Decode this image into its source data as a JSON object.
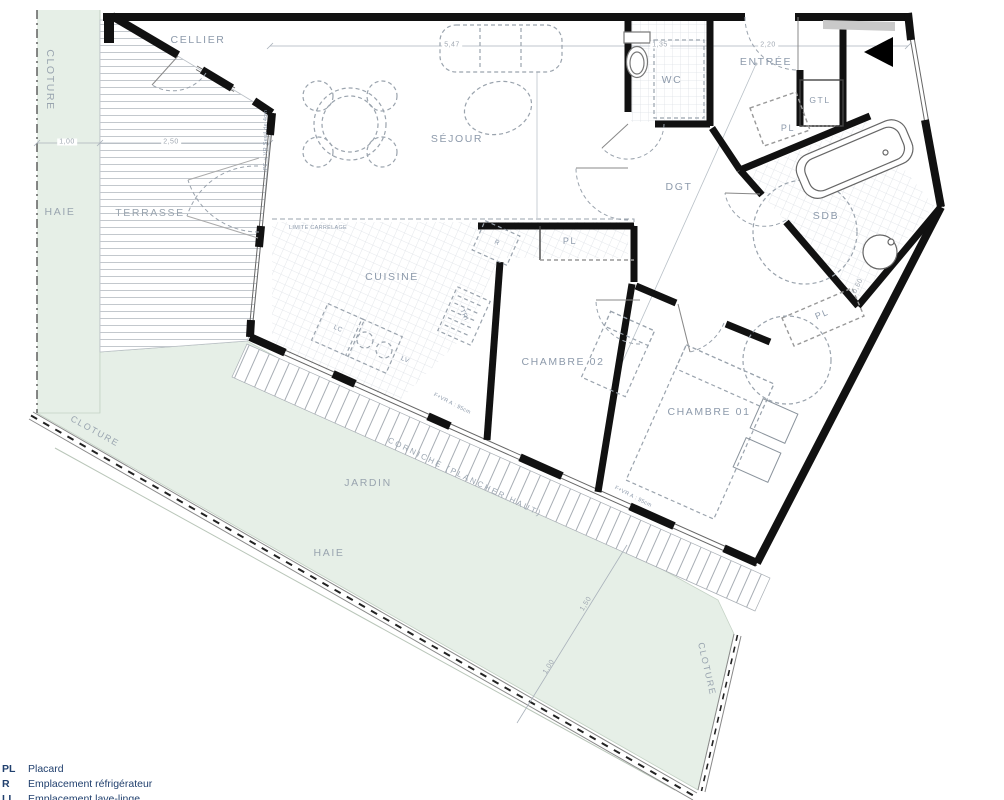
{
  "labels": {
    "cellier": "CELLIER",
    "sejour": "SÉJOUR",
    "wc": "WC",
    "entree": "ENTRÉE",
    "gtl": "GTL",
    "dgt": "DGT",
    "sdb": "SDB",
    "cuisine": "CUISINE",
    "chambre02": "CHAMBRE 02",
    "chambre01": "CHAMBRE 01",
    "pl": "PL",
    "terrasse": "TERRASSE",
    "jardin": "JARDIN",
    "haie": "HAIE",
    "cloture": "CLOTURE",
    "limite_carrelage": "LIMITE CARRELAGE",
    "corniche": "CORNICHE (PLANCHER HAUT)",
    "pf_vr_seuil": "PF + VR  Seuil de 4cm",
    "f_vr_allege": "F+VR  A : 95cm",
    "r": "R",
    "tri": "TRI",
    "lc": "LC",
    "lv": "LV"
  },
  "dimensions": {
    "haie_w": "1,00",
    "terrasse_w": "2,50",
    "sejour_w": "5,47",
    "wc_w": "1,35",
    "entree_w": "2,20",
    "jardin_a": "1,50",
    "jardin_b": "1,00",
    "sdb_a": "0,60"
  },
  "legend": {
    "rows": [
      {
        "code": "PL",
        "label": "Placard"
      },
      {
        "code": "R",
        "label": "Emplacement réfrigérateur"
      },
      {
        "code": "LL",
        "label": "Emplacement lave-linge"
      }
    ]
  },
  "colors": {
    "garden": "#e6efe7",
    "wall": "#111111",
    "room_label": "#8d9aab",
    "legend_text": "#21406e"
  }
}
